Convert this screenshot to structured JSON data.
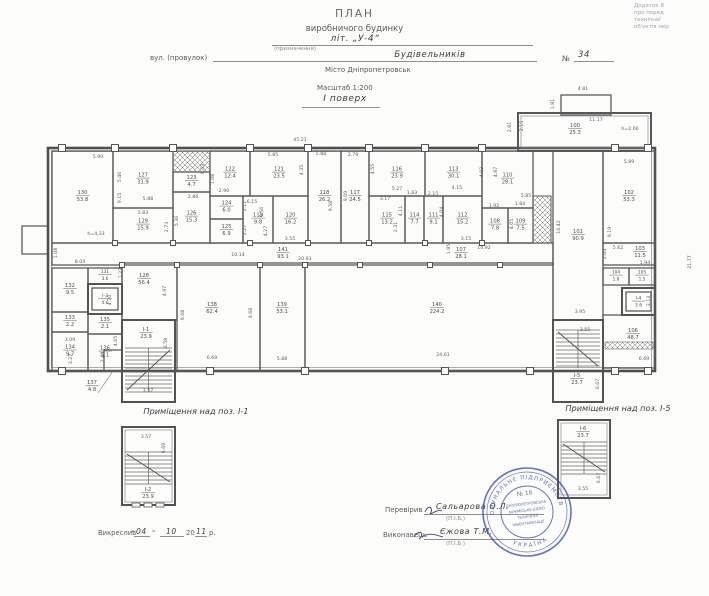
{
  "appendix": {
    "lines": [
      "Додаток 8",
      "про поряд",
      "технічної",
      "об'єктів нер"
    ]
  },
  "header": {
    "title": "ПЛАН",
    "subtitle": "виробничого будинку",
    "liter": "літ. „У-4“",
    "liter_caption": "(призначення)",
    "street_label": "вул. (провулок)",
    "street_value": "Будівельників",
    "number_label": "№",
    "number_value": "34",
    "city": "Місто  Дніпропетровськ",
    "scale": "Масштаб 1:200",
    "floor": "І поверх"
  },
  "plan": {
    "rooms": [
      {
        "num": "130",
        "area": "53.8",
        "x": 52,
        "y": 151,
        "w": 61,
        "h": 92
      },
      {
        "num": "127",
        "area": "31.9",
        "x": 113,
        "y": 151,
        "w": 60,
        "h": 57
      },
      {
        "num": "129",
        "area": "15.9",
        "x": 113,
        "y": 208,
        "w": 60,
        "h": 35
      },
      {
        "num": "123",
        "area": "4.7",
        "x": 173,
        "y": 172,
        "w": 37,
        "h": 20
      },
      {
        "num": "126",
        "area": "15.3",
        "x": 173,
        "y": 192,
        "w": 37,
        "h": 51
      },
      {
        "num": "122",
        "area": "12.4",
        "x": 210,
        "y": 151,
        "w": 40,
        "h": 45
      },
      {
        "num": "124",
        "area": "6.0",
        "x": 210,
        "y": 196,
        "w": 33,
        "h": 23
      },
      {
        "num": "125",
        "area": "6.9",
        "x": 210,
        "y": 219,
        "w": 33,
        "h": 24
      },
      {
        "num": "121",
        "area": "23.5",
        "x": 250,
        "y": 151,
        "w": 58,
        "h": 45
      },
      {
        "num": "119",
        "area": "9.8",
        "x": 243,
        "y": 196,
        "w": 30,
        "h": 47
      },
      {
        "num": "120",
        "area": "16.2",
        "x": 273,
        "y": 196,
        "w": 35,
        "h": 47
      },
      {
        "num": "118",
        "area": "26.2",
        "x": 308,
        "y": 151,
        "w": 33,
        "h": 92
      },
      {
        "num": "117",
        "area": "24.5",
        "x": 341,
        "y": 151,
        "w": 28,
        "h": 92
      },
      {
        "num": "116",
        "area": "23.9",
        "x": 369,
        "y": 151,
        "w": 56,
        "h": 45
      },
      {
        "num": "115",
        "area": "13.2",
        "x": 369,
        "y": 196,
        "w": 36,
        "h": 47
      },
      {
        "num": "114",
        "area": "7.7",
        "x": 405,
        "y": 196,
        "w": 19,
        "h": 47
      },
      {
        "num": "113",
        "area": "30.1",
        "x": 425,
        "y": 151,
        "w": 57,
        "h": 45
      },
      {
        "num": "111",
        "area": "9.1",
        "x": 424,
        "y": 196,
        "w": 19,
        "h": 47
      },
      {
        "num": "112",
        "area": "15.2",
        "x": 443,
        "y": 196,
        "w": 39,
        "h": 47
      },
      {
        "num": "110",
        "area": "28.1",
        "x": 482,
        "y": 151,
        "w": 51,
        "h": 57
      },
      {
        "num": "108",
        "area": "7.8",
        "x": 482,
        "y": 208,
        "w": 26,
        "h": 35
      },
      {
        "num": "109",
        "area": "7.5",
        "x": 508,
        "y": 208,
        "w": 25,
        "h": 35
      },
      {
        "num": "102",
        "area": "53.3",
        "x": 603,
        "y": 151,
        "w": 52,
        "h": 92
      },
      {
        "num": "101",
        "area": "90.9",
        "x": 553,
        "y": 151,
        "w": 50,
        "h": 169,
        "lx": 578,
        "ly": 233
      },
      {
        "num": "100",
        "area": "25.3",
        "x": 518,
        "y": 113,
        "w": 133,
        "h": 38,
        "lx": 575,
        "ly": 127
      },
      {
        "num": "141",
        "area": "93.1",
        "x": 52,
        "y": 243,
        "w": 501,
        "h": 22,
        "lx": 283,
        "ly": 251
      },
      {
        "num": "107",
        "area": "28.1",
        "label_only": true,
        "lx": 461,
        "ly": 251
      },
      {
        "num": "103",
        "area": "11.5",
        "x": 603,
        "y": 243,
        "w": 52,
        "h": 22,
        "lx": 640,
        "ly": 250
      },
      {
        "num": "104",
        "area": "1.8",
        "x": 603,
        "y": 268,
        "w": 26,
        "h": 17
      },
      {
        "num": "105",
        "area": "1.5",
        "x": 629,
        "y": 268,
        "w": 26,
        "h": 17
      },
      {
        "num": "106",
        "area": "48.7",
        "x": 603,
        "y": 315,
        "w": 52,
        "h": 53,
        "lx": 633,
        "ly": 332
      },
      {
        "num": "131",
        "area": "3.6",
        "x": 88,
        "y": 268,
        "w": 34,
        "h": 16
      },
      {
        "num": "132",
        "area": "9.5",
        "x": 52,
        "y": 268,
        "w": 36,
        "h": 44
      },
      {
        "num": "133",
        "area": "2.2",
        "x": 52,
        "y": 312,
        "w": 36,
        "h": 20
      },
      {
        "num": "134",
        "area": "9.7",
        "x": 52,
        "y": 332,
        "w": 36,
        "h": 39
      },
      {
        "num": "135",
        "area": "2.1",
        "x": 88,
        "y": 314,
        "w": 34,
        "h": 20
      },
      {
        "num": "136",
        "area": "5.1",
        "x": 88,
        "y": 334,
        "w": 34,
        "h": 37
      },
      {
        "num": "137",
        "area": "4.8",
        "x": 104,
        "y": 350,
        "w": 18,
        "h": 21,
        "lx": 92,
        "ly": 384,
        "leader": true
      },
      {
        "num": "128",
        "area": "56.4",
        "x": 122,
        "y": 263,
        "w": 55,
        "h": 57,
        "lx": 144,
        "ly": 277
      },
      {
        "num": "138",
        "area": "62.4",
        "x": 177,
        "y": 263,
        "w": 83,
        "h": 108,
        "lx": 212,
        "ly": 306
      },
      {
        "num": "139",
        "area": "53.1",
        "x": 260,
        "y": 263,
        "w": 45,
        "h": 108,
        "lx": 282,
        "ly": 306
      },
      {
        "num": "140",
        "area": "224.2",
        "x": 305,
        "y": 263,
        "w": 248,
        "h": 108,
        "lx": 437,
        "ly": 306
      }
    ],
    "elevators": [
      {
        "num": "І-3",
        "area": "4.6",
        "x": 88,
        "y": 284,
        "w": 34,
        "h": 30
      },
      {
        "num": "І-4",
        "area": "3.6",
        "x": 622,
        "y": 288,
        "w": 33,
        "h": 27
      }
    ],
    "stairwells": [
      {
        "num": "І-1",
        "area": "23.9",
        "x": 122,
        "y": 320,
        "w": 53,
        "h": 82,
        "lx": 146,
        "ly": 331,
        "t1": 348,
        "t2": 392,
        "dir": 1
      },
      {
        "num": "І-5",
        "area": "23.7",
        "x": 553,
        "y": 320,
        "w": 50,
        "h": 82,
        "lx": 577,
        "ly": 377,
        "t1": 330,
        "t2": 368,
        "dir": -1
      }
    ],
    "dims": [
      {
        "t": "45.21",
        "x": 300,
        "y": 141
      },
      {
        "t": "4.81",
        "x": 583,
        "y": 90
      },
      {
        "t": "1.81",
        "x": 554,
        "y": 104,
        "r": 1
      },
      {
        "t": "2.81",
        "x": 511,
        "y": 127,
        "r": 1
      },
      {
        "t": "2.15",
        "x": 523,
        "y": 126,
        "r": 1
      },
      {
        "t": "11.17",
        "x": 596,
        "y": 121
      },
      {
        "t": "h=2.60",
        "x": 630,
        "y": 130
      },
      {
        "t": "5.90",
        "x": 98,
        "y": 158
      },
      {
        "t": "9.15",
        "x": 121,
        "y": 198,
        "r": 1
      },
      {
        "t": "h=4,33",
        "x": 96,
        "y": 235
      },
      {
        "t": "5.46",
        "x": 121,
        "y": 177,
        "r": 1
      },
      {
        "t": "5.88",
        "x": 148,
        "y": 200
      },
      {
        "t": "5.83",
        "x": 143,
        "y": 214
      },
      {
        "t": "2.73",
        "x": 168,
        "y": 227,
        "r": 1
      },
      {
        "t": "9.63",
        "x": 204,
        "y": 169,
        "r": 1
      },
      {
        "t": "1.08",
        "x": 214,
        "y": 179,
        "r": 1
      },
      {
        "t": "2.90",
        "x": 224,
        "y": 192
      },
      {
        "t": "2.86",
        "x": 193,
        "y": 198
      },
      {
        "t": "5.36",
        "x": 178,
        "y": 221,
        "r": 1
      },
      {
        "t": "5.85",
        "x": 273,
        "y": 156
      },
      {
        "t": "4.35",
        "x": 303,
        "y": 170,
        "r": 1
      },
      {
        "t": "6.15",
        "x": 252,
        "y": 203
      },
      {
        "t": "2.11",
        "x": 246,
        "y": 206,
        "r": 1
      },
      {
        "t": "2.27",
        "x": 246,
        "y": 230,
        "r": 1
      },
      {
        "t": "4.27",
        "x": 267,
        "y": 231,
        "r": 1
      },
      {
        "t": "9.56",
        "x": 263,
        "y": 212,
        "r": 1
      },
      {
        "t": "3.55",
        "x": 290,
        "y": 240
      },
      {
        "t": "5.88",
        "x": 321,
        "y": 155
      },
      {
        "t": "9.58",
        "x": 332,
        "y": 206,
        "r": 1
      },
      {
        "t": "2.79",
        "x": 353,
        "y": 156
      },
      {
        "t": "9.09",
        "x": 347,
        "y": 196,
        "r": 1
      },
      {
        "t": "4.55",
        "x": 374,
        "y": 169,
        "r": 1
      },
      {
        "t": "5.27",
        "x": 397,
        "y": 190
      },
      {
        "t": "3.17",
        "x": 385,
        "y": 200
      },
      {
        "t": "2.31",
        "x": 397,
        "y": 227,
        "r": 1
      },
      {
        "t": "1.83",
        "x": 412,
        "y": 194
      },
      {
        "t": "4.11",
        "x": 402,
        "y": 211,
        "r": 1
      },
      {
        "t": "2.15",
        "x": 433,
        "y": 195
      },
      {
        "t": "4.04",
        "x": 443,
        "y": 212,
        "r": 1
      },
      {
        "t": "4.93",
        "x": 483,
        "y": 172,
        "r": 1
      },
      {
        "t": "4.87",
        "x": 497,
        "y": 172,
        "r": 1
      },
      {
        "t": "4.15",
        "x": 457,
        "y": 189
      },
      {
        "t": "5.85",
        "x": 526,
        "y": 197
      },
      {
        "t": "1.92",
        "x": 494,
        "y": 207
      },
      {
        "t": "1.84",
        "x": 520,
        "y": 205
      },
      {
        "t": "4.05",
        "x": 513,
        "y": 224,
        "r": 1
      },
      {
        "t": "3.15",
        "x": 466,
        "y": 240
      },
      {
        "t": "14.92",
        "x": 484,
        "y": 249
      },
      {
        "t": "1.95",
        "x": 450,
        "y": 249,
        "r": 1
      },
      {
        "t": "20.81",
        "x": 305,
        "y": 260
      },
      {
        "t": "10.14",
        "x": 238,
        "y": 256
      },
      {
        "t": "8.04",
        "x": 80,
        "y": 263
      },
      {
        "t": "1.08",
        "x": 57,
        "y": 253,
        "r": 1
      },
      {
        "t": "1.27",
        "x": 122,
        "y": 273,
        "r": 1
      },
      {
        "t": "16.42",
        "x": 560,
        "y": 227,
        "r": 1
      },
      {
        "t": "5.89",
        "x": 629,
        "y": 163
      },
      {
        "t": "9.19",
        "x": 611,
        "y": 232,
        "r": 1
      },
      {
        "t": "21.77",
        "x": 691,
        "y": 262,
        "r": 1
      },
      {
        "t": "5.62",
        "x": 618,
        "y": 249
      },
      {
        "t": "2.04",
        "x": 606,
        "y": 254,
        "r": 1
      },
      {
        "t": "1.94",
        "x": 645,
        "y": 264
      },
      {
        "t": "3.13",
        "x": 650,
        "y": 301,
        "r": 1
      },
      {
        "t": "3.95",
        "x": 580,
        "y": 313
      },
      {
        "t": "3.55",
        "x": 585,
        "y": 331
      },
      {
        "t": "6.67",
        "x": 599,
        "y": 384,
        "r": 1
      },
      {
        "t": "3.57",
        "x": 148,
        "y": 392
      },
      {
        "t": "6.58",
        "x": 167,
        "y": 343,
        "r": 1
      },
      {
        "t": "4.97",
        "x": 166,
        "y": 291,
        "r": 1
      },
      {
        "t": "9.68",
        "x": 184,
        "y": 315,
        "r": 1
      },
      {
        "t": "9.68",
        "x": 252,
        "y": 313,
        "r": 1
      },
      {
        "t": "4.70",
        "x": 111,
        "y": 300,
        "r": 1
      },
      {
        "t": "3.09",
        "x": 70,
        "y": 341
      },
      {
        "t": "3.27",
        "x": 72,
        "y": 359,
        "r": 1
      },
      {
        "t": "4.65",
        "x": 117,
        "y": 341,
        "r": 1
      },
      {
        "t": "2.43",
        "x": 104,
        "y": 357,
        "r": 1
      },
      {
        "t": "6.69",
        "x": 212,
        "y": 359
      },
      {
        "t": "5.88",
        "x": 282,
        "y": 360
      },
      {
        "t": "24.61",
        "x": 443,
        "y": 356
      },
      {
        "t": "6.69",
        "x": 644,
        "y": 360
      }
    ],
    "details": [
      {
        "caption": "Приміщення над поз. І-1",
        "cx": 196,
        "cy": 414,
        "num": "І-2",
        "area": "23.9",
        "x": 122,
        "y": 427,
        "w": 53,
        "h": 78,
        "dim_w": "3.57",
        "dw_x": 146,
        "dw_y": 438,
        "dim_h": "6.69",
        "dh_x": 165,
        "dh_y": 448,
        "t1": 452,
        "t2": 484,
        "lx": 148,
        "ly": 491,
        "ticks": true
      },
      {
        "caption": "Приміщення над поз. І-5",
        "cx": 618,
        "cy": 411,
        "num": "І-6",
        "area": "23.7",
        "x": 558,
        "y": 420,
        "w": 52,
        "h": 78,
        "dim_w": "3.55",
        "dw_x": 583,
        "dw_y": 490,
        "dim_h": "6.67",
        "dh_x": 600,
        "dh_y": 478,
        "t1": 442,
        "t2": 474,
        "lx": 583,
        "ly": 430,
        "ticks": false
      }
    ]
  },
  "footer": {
    "drawn_label": "Викреслив",
    "q1": "\"",
    "drawn_day": "04",
    "q2": "\"",
    "drawn_month": "10",
    "year_prefix": "20",
    "drawn_year": "11",
    "year_suffix": "р.",
    "checked_label": "Перевірив",
    "checked_name": "Сальарова О.Л.",
    "pib": "(П.І.Б.)",
    "executor_label": "Виконавець",
    "executor_name": "Єжова Т.М."
  },
  "stamp": {
    "top": "КОМУНАЛЬНЕ ПІДПРИЄМСТВО",
    "no": "№ 16",
    "center_lines": [
      "ДНІПРОПЕТРОВСЬКЕ",
      "МІЖМІСЬКЕ БЮРО",
      "ТЕХНІЧНОЇ",
      "ІНВЕНТАРИЗАЦІЇ"
    ],
    "bottom": "УКРАЇНА"
  }
}
